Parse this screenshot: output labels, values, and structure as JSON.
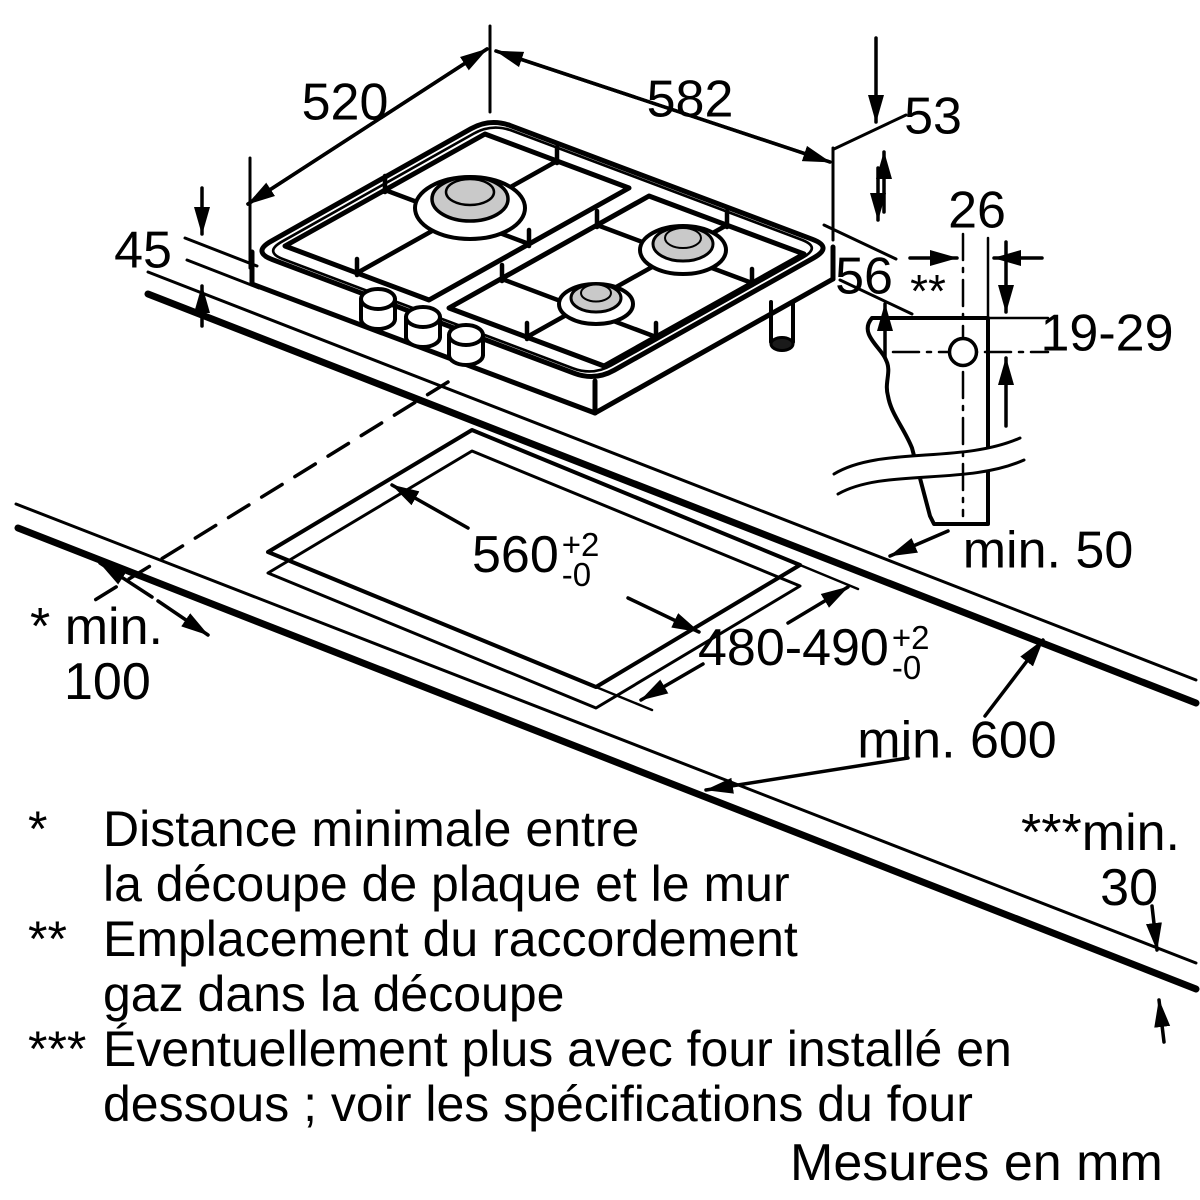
{
  "units_note": "Mesures en mm",
  "dimensions": {
    "hob_depth": "520",
    "hob_width": "582",
    "edge_height": "53",
    "front_height": "45",
    "gas_offset_side": "26",
    "gas_drop": "56",
    "gas_drop_marker": "**",
    "gas_hole_range": "19-29",
    "rear_clearance": "min. 50",
    "worktop_depth": "min. 600",
    "cutout_width": {
      "value": "560",
      "tol_plus": "+2",
      "tol_minus": "-0"
    },
    "cutout_depth": {
      "value": "480-490",
      "tol_plus": "+2",
      "tol_minus": "-0"
    },
    "side_clearance": {
      "marker": "*",
      "line1": "min.",
      "line2": "100"
    },
    "worktop_thickness": {
      "marker": "***",
      "line1": "min.",
      "line2": "30"
    }
  },
  "footnotes": [
    {
      "symbol": "*",
      "line1": "Distance minimale entre",
      "line2": "la découpe de plaque et le mur"
    },
    {
      "symbol": "**",
      "line1": "Emplacement du raccordement",
      "line2": "gaz dans la découpe"
    },
    {
      "symbol": "***",
      "line1": "Éventuellement plus avec four installé en",
      "line2": "dessous ; voir les spécifications du four"
    }
  ],
  "colors": {
    "line": "#000000",
    "burner_cap_fill": "#c9c9c9",
    "gas_pipe_cap_fill": "#1a1a1a",
    "background": "#ffffff"
  }
}
